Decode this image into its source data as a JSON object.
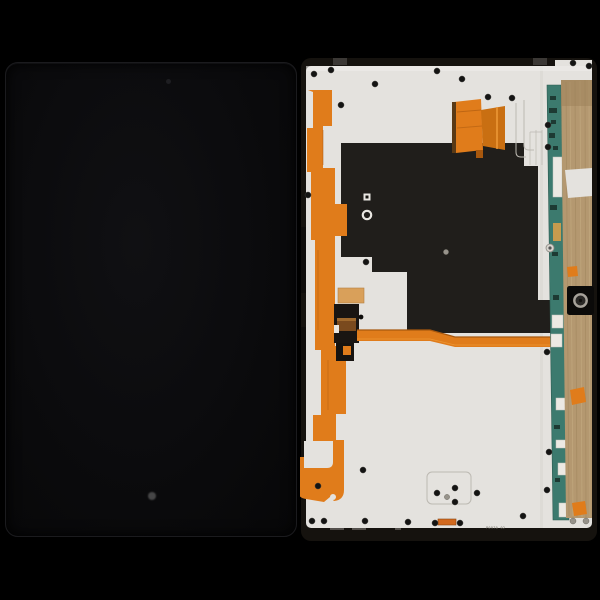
{
  "photo": {
    "etched_label": "P0970 02"
  },
  "colors": {
    "background": "#000000",
    "frame": "#15120e",
    "plate": "#e4e2de",
    "plate-shade": "#d6d3ce",
    "graphite": "#201e1b",
    "flex-orange": "#e07c1b",
    "flex-orange-dark": "#a8580e",
    "flex-orange-light": "#f09c3a",
    "flex-fold": "#c96f12",
    "connector-gold": "#d9a05a",
    "connector-bronze": "#7a4a1e",
    "pcb-teal": "#3c7a6e",
    "pcb-chip": "#1d3a33",
    "pcb-gold": "#c79b4e",
    "tan-strip": "#b49870",
    "tan-dark": "#9a7f57",
    "camera-black": "#0b0a09",
    "camera-ring": "#a7a29a",
    "screw": "#141413",
    "screw-light": "#97938b",
    "etch": "#bcb9b2",
    "camera-dot": "#1e1e22",
    "panel-dot": "#464647"
  },
  "screws": {
    "dark": [
      [
        314,
        74
      ],
      [
        331,
        70
      ],
      [
        341,
        105
      ],
      [
        375,
        84
      ],
      [
        437,
        71
      ],
      [
        462,
        79
      ],
      [
        488,
        97
      ],
      [
        512,
        98
      ],
      [
        573,
        63
      ],
      [
        589,
        66
      ],
      [
        308,
        195
      ],
      [
        366,
        262
      ],
      [
        363,
        470
      ],
      [
        318,
        486
      ],
      [
        312,
        521
      ],
      [
        324,
        521
      ],
      [
        365,
        521
      ],
      [
        408,
        522
      ],
      [
        435,
        523
      ],
      [
        460,
        523
      ],
      [
        523,
        516
      ],
      [
        548,
        125
      ],
      [
        548,
        147
      ],
      [
        547,
        352
      ],
      [
        549,
        452
      ],
      [
        547,
        490
      ],
      [
        437,
        493
      ],
      [
        455,
        488
      ],
      [
        477,
        493
      ],
      [
        455,
        502
      ]
    ],
    "light": [
      [
        447,
        497
      ],
      [
        446,
        252
      ]
    ]
  }
}
